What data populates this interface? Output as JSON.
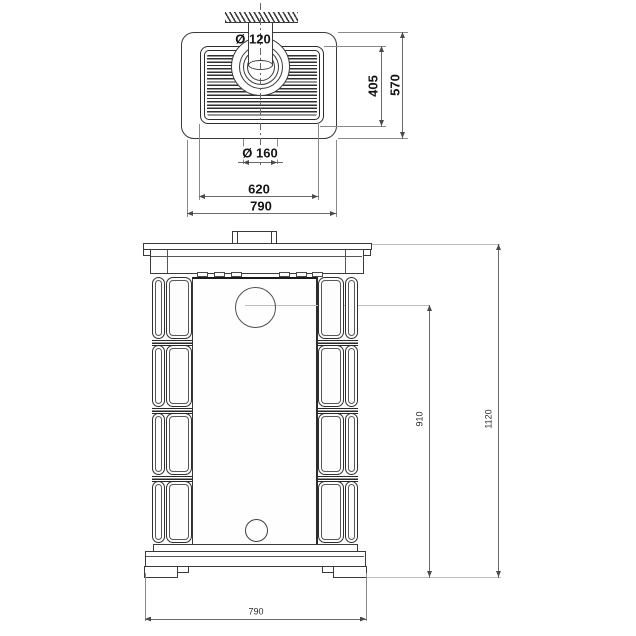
{
  "views": {
    "top": {
      "dims": {
        "pipe_diameter": "Ø 120",
        "collar_diameter": "Ø 160",
        "grille_depth": "405",
        "top_depth": "570",
        "grille_width": "620",
        "top_width": "790"
      }
    },
    "front": {
      "dims": {
        "flue_center_height": "910",
        "total_height": "1120",
        "base_width": "790"
      }
    }
  },
  "colors": {
    "object_line": "#3a3a3a",
    "dimension_line": "#8a8a8a",
    "text": "#141414",
    "background": "#ffffff"
  }
}
